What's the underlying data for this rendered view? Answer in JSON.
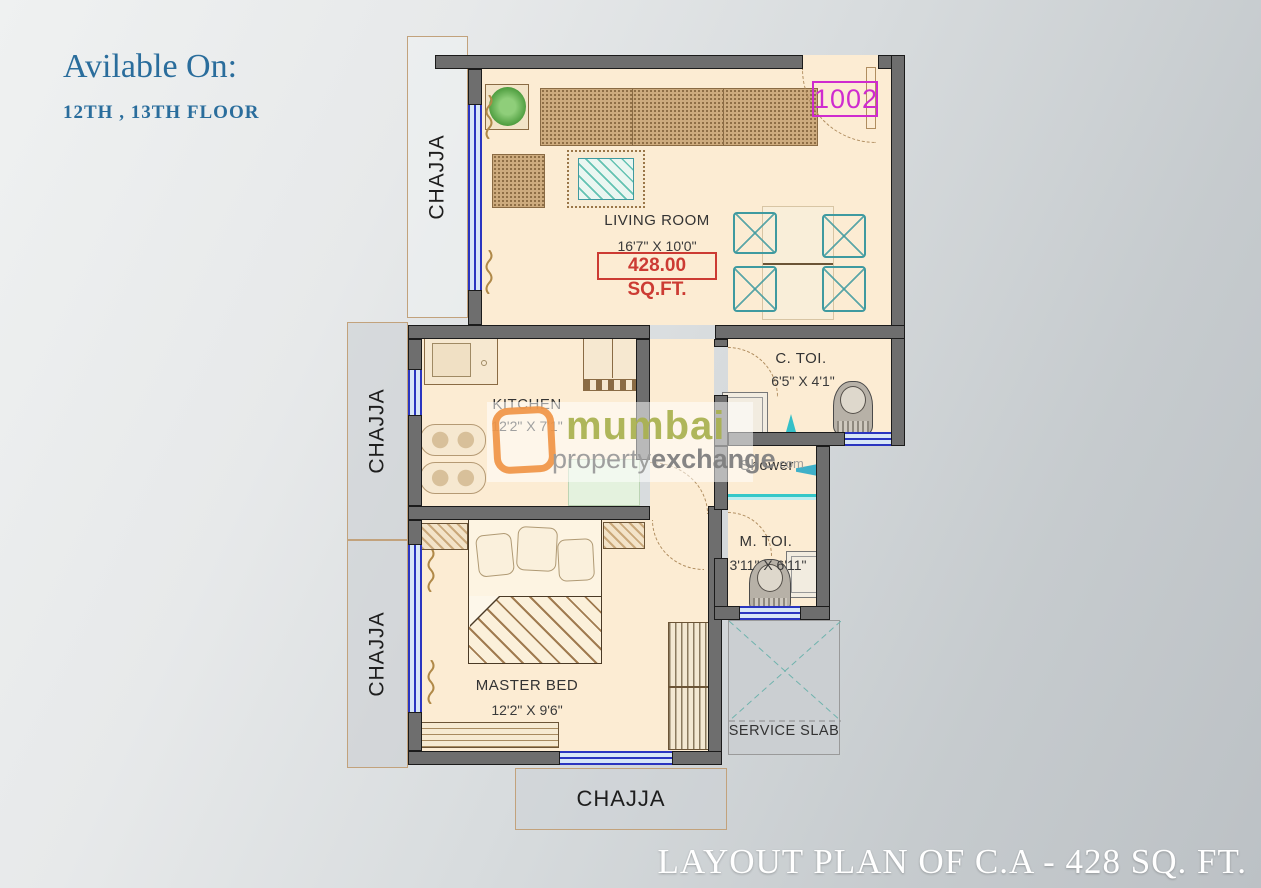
{
  "header": {
    "title": "Avilable On:",
    "subtitle": "12TH , 13TH FLOOR"
  },
  "unit": {
    "number": "1002"
  },
  "rooms": {
    "living": {
      "name": "LIVING ROOM",
      "dim": "16'7\" X 10'0\"",
      "area": "428.00 SQ.FT."
    },
    "kitchen": {
      "name": "KITCHEN",
      "dim": "12'2\" X 7'1\""
    },
    "c_toi": {
      "name": "C. TOI.",
      "dim": "6'5\" X 4'1\""
    },
    "shower": {
      "name": "Shower"
    },
    "m_toi": {
      "name": "M. TOI.",
      "dim": "3'11\" X 6'11\""
    },
    "master": {
      "name": "MASTER BED",
      "dim": "12'2\" X 9'6\""
    },
    "service_slab": {
      "name": "SERVICE SLAB"
    }
  },
  "chajja": {
    "top": "CHAJJA",
    "middle": "CHAJJA",
    "lower": "CHAJJA",
    "bottom": "CHAJJA"
  },
  "watermark": {
    "brand": "mumbai",
    "line2_light": "property",
    "line2_bold": "exchange",
    "tld": ".com"
  },
  "footer": {
    "title": "LAYOUT PLAN OF C.A - 428 SQ. FT."
  },
  "colors": {
    "heading_blue": "#2a6d9c",
    "unit_magenta": "#cf2bcf",
    "area_red": "#cc3b33",
    "wall_gray": "#6e6e6e",
    "room_cream": "#fcecd3",
    "window_blue": "#2a35c0",
    "watermark_olive": "#a9b14e",
    "watermark_orange": "#ef9243",
    "footer_white": "#ffffff"
  }
}
